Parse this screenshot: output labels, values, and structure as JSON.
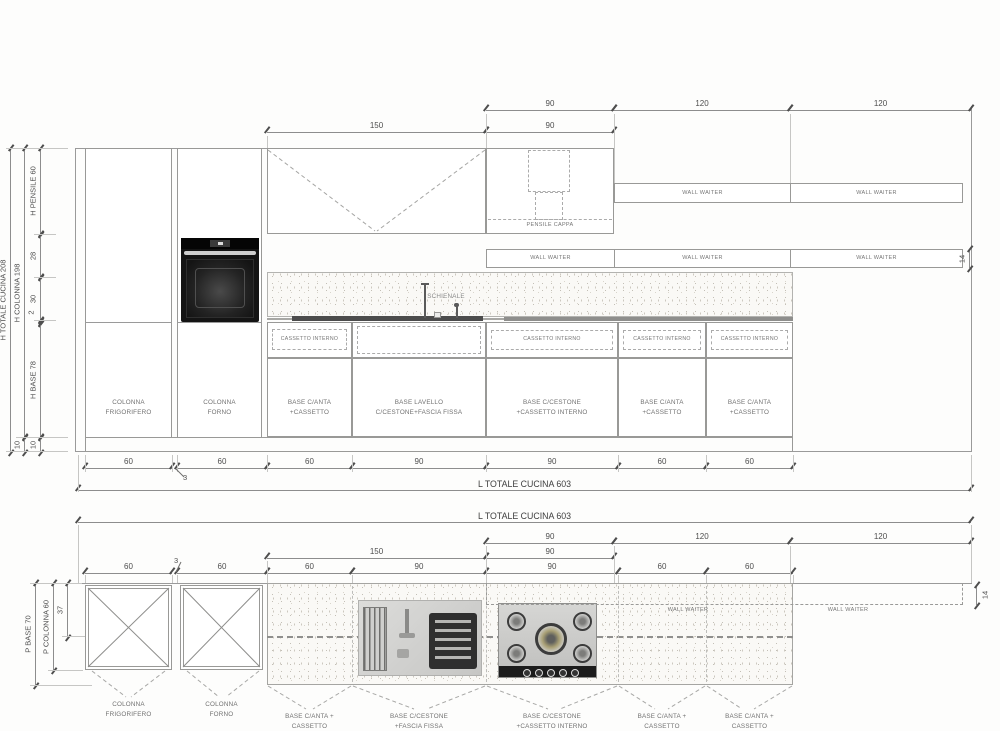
{
  "colors": {
    "line": "#9a9a9a",
    "dim_text": "#4e4e4e",
    "label_text": "#717171",
    "appliance_dark": "#141414",
    "countertop_dark": "#4c4c4c"
  },
  "elevation": {
    "vdims": {
      "h_totale_cucina": "H TOTALE CUCINA 208",
      "h_colonna": "H COLONNA 198",
      "h_pensile": "H PENSILE 60",
      "gap_28": "28",
      "gap_30": "30",
      "gap_2": "2",
      "h_base": "H BASE 78",
      "plinth_10_a": "10",
      "plinth_10_b": "10",
      "wall_unit_14": "14"
    },
    "top_dims": {
      "w90_a": "90",
      "w120_a": "120",
      "w120_b": "120",
      "w150": "150",
      "w90_b": "90"
    },
    "chain": [
      "60",
      "3",
      "60",
      "60",
      "90",
      "90",
      "60",
      "60"
    ],
    "total": "L TOTALE CUCINA 603",
    "labels": {
      "pensile_cappa": "PENSILE CAPPA",
      "schienale": "SCHIENALE",
      "wall_waiter": "WALL WAITER",
      "cassetto_interno": "CASSETTO INTERNO"
    },
    "units": [
      "COLONNA\nFRIGORIFERO",
      "COLONNA\nFORNO",
      "BASE C/ANTA\n+CASSETTO",
      "BASE LAVELLO\nC/CESTONE+FASCIA FISSA",
      "BASE C/CESTONE\n+CASSETTO INTERNO",
      "BASE C/ANTA\n+CASSETTO",
      "BASE C/ANTA\n+CASSETTO"
    ]
  },
  "plan": {
    "top_dims": {
      "total": "L TOTALE CUCINA 603",
      "w90_a": "90",
      "w120_a": "120",
      "w120_b": "120",
      "w150": "150",
      "w90_b": "90"
    },
    "chain": [
      "60",
      "3",
      "60",
      "60",
      "90",
      "90",
      "60",
      "60"
    ],
    "vdims": {
      "p_base": "P BASE 70",
      "p_colonna": "P COLONNA 60",
      "d37": "37",
      "wall_depth_14": "14"
    },
    "labels": {
      "wall_waiter": "WALL WAITER"
    },
    "units": [
      "COLONNA\nFRIGORIFERO",
      "COLONNA\nFORNO",
      "BASE C/ANTA +\nCASSETTO",
      "BASE C/CESTONE\n+FASCIA FISSA",
      "BASE C/CESTONE\n+CASSETTO INTERNO",
      "BASE C/ANTA +\nCASSETTO",
      "BASE C/ANTA +\nCASSETTO"
    ]
  }
}
